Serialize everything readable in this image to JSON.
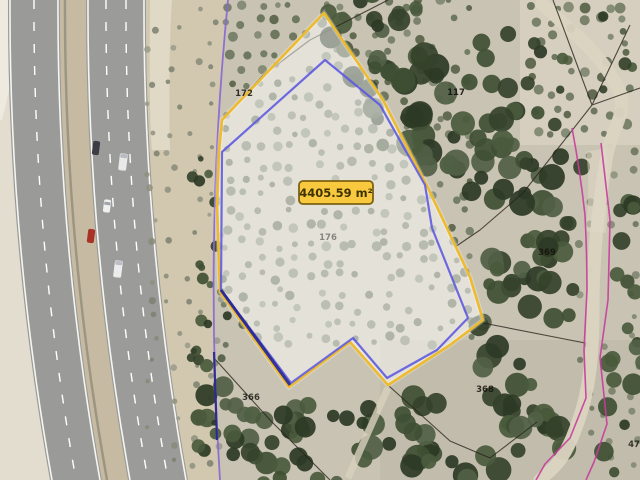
{
  "map": {
    "view_type": "aerial-cadastral",
    "area_label": {
      "text": "4405.59 m²"
    },
    "parcel_labels": [
      {
        "text": "172",
        "x": 244,
        "y": 96,
        "opacity": 0.85
      },
      {
        "text": "117",
        "x": 456,
        "y": 95,
        "opacity": 0.9
      },
      {
        "text": "176",
        "x": 328,
        "y": 240,
        "opacity": 0.45
      },
      {
        "text": "369",
        "x": 547,
        "y": 255,
        "opacity": 0.85
      },
      {
        "text": "366",
        "x": 251,
        "y": 400,
        "opacity": 0.8
      },
      {
        "text": "368",
        "x": 485,
        "y": 392,
        "opacity": 0.85
      },
      {
        "text": "47",
        "x": 634,
        "y": 447,
        "opacity": 0.8
      }
    ],
    "colors": {
      "parcel_fill": "rgba(255,255,255,0.5)",
      "parcel_outer_stroke": "#edbb2d",
      "parcel_inner_stroke": "#5b58e0",
      "parcel_overlap_navy": "#23238f",
      "area_box_fill": "#f8c93e",
      "area_box_border": "#7c6212",
      "area_text": "#3e3200",
      "cadastral_purple": "#8767d3",
      "cadastral_magenta": "#c93c9c",
      "cadastral_black": "#26221a",
      "label_color": "#14120c"
    }
  }
}
